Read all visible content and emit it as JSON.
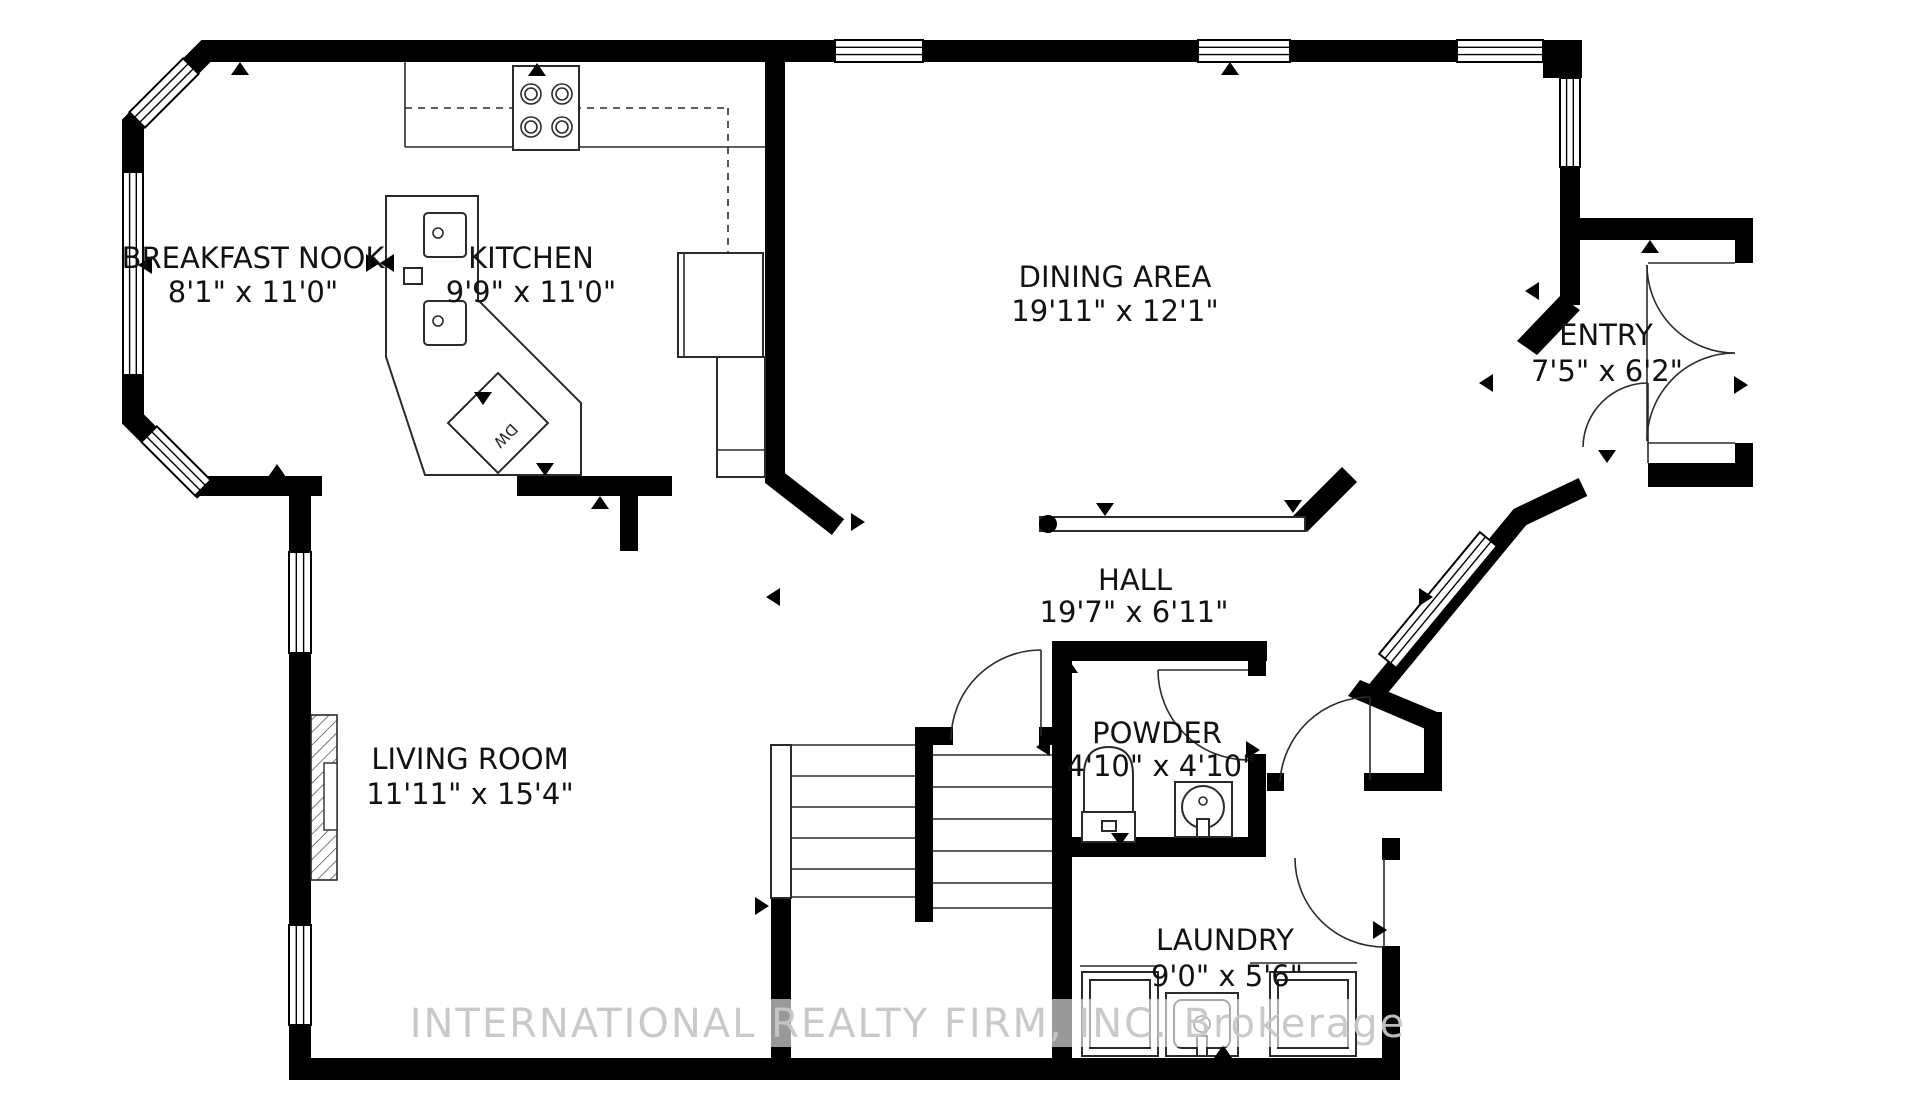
{
  "colors": {
    "background": "#ffffff",
    "walls": "#000000",
    "lines": "#2b2b2b",
    "watermark": "#c7c7c7"
  },
  "rooms": [
    {
      "id": "breakfast-nook",
      "name": "BREAKFAST NOOK",
      "dims": "8'1\" x 11'0\""
    },
    {
      "id": "kitchen",
      "name": "KITCHEN",
      "dims": "9'9\" x 11'0\""
    },
    {
      "id": "dining-area",
      "name": "DINING AREA",
      "dims": "19'11\" x 12'1\""
    },
    {
      "id": "entry",
      "name": "ENTRY",
      "dims": "7'5\" x 6'2\""
    },
    {
      "id": "hall",
      "name": "HALL",
      "dims": "19'7\" x 6'11\""
    },
    {
      "id": "living-room",
      "name": "LIVING ROOM",
      "dims": "11'11\" x 15'4\""
    },
    {
      "id": "powder",
      "name": "POWDER",
      "dims": "4'10\" x 4'10\""
    },
    {
      "id": "laundry",
      "name": "LAUNDRY",
      "dims": "9'0\" x 5'6\""
    }
  ],
  "fixtures": {
    "dishwasher_label": "DW"
  },
  "watermark": {
    "text": "INTERNATIONAL REALTY FIRM, INC.  Brokerage"
  }
}
